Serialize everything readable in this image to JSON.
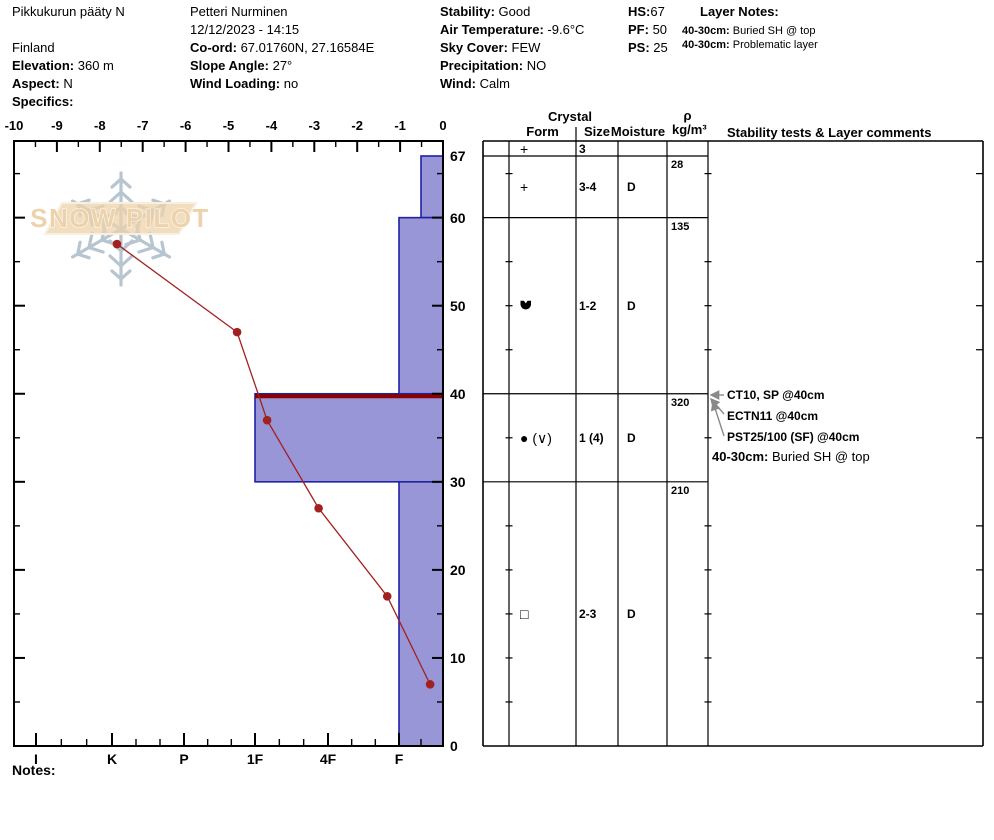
{
  "header": {
    "site": "Pikkukurun pääty N",
    "country": "Finland",
    "observer": "Petteri Nurminen",
    "datetime": "12/12/2023 - 14:15",
    "labels": {
      "elevation": "Elevation:",
      "aspect": "Aspect:",
      "specifics": "Specifics:",
      "coord": "Co-ord:",
      "slope": "Slope Angle:",
      "wind_loading": "Wind Loading:",
      "stability": "Stability:",
      "air_temp": "Air Temperature:",
      "sky": "Sky Cover:",
      "precip": "Precipitation:",
      "wind": "Wind:",
      "hs": "HS:",
      "pf": "PF:",
      "ps": "PS:",
      "layer_notes": "Layer Notes:"
    },
    "values": {
      "elevation": "360 m",
      "aspect": "N",
      "specifics": "",
      "coord": "67.01760N, 27.16584E",
      "slope": "27°",
      "wind_loading": "no",
      "stability": "Good",
      "air_temp": "-9.6°C",
      "sky": "FEW",
      "precip": "NO",
      "wind": "Calm",
      "hs": "67",
      "pf": "50",
      "ps": "25"
    },
    "layer_notes": [
      {
        "range": "40-30cm:",
        "text": "Buried SH @ top"
      },
      {
        "range": "40-30cm:",
        "text": "Problematic layer"
      }
    ]
  },
  "chart_data": {
    "type": "snow-profile",
    "snow_height_cm": 67,
    "temperature_axis": {
      "unit": "°C",
      "min": -10,
      "max": 0,
      "tick_labels": [
        "-10",
        "-9",
        "-8",
        "-7",
        "-6",
        "-5",
        "-4",
        "-3",
        "-2",
        "-1",
        "0"
      ]
    },
    "height_axis": {
      "unit": "cm",
      "min": 0,
      "top_cm": 68.7,
      "tick_labels": [
        67,
        60,
        50,
        40,
        30,
        20,
        10,
        0
      ]
    },
    "hardness_axis": {
      "labels": [
        "I",
        "K",
        "P",
        "1F",
        "4F",
        "F"
      ]
    },
    "temperature_profile": [
      {
        "height_cm": 57,
        "temp_c": -7.6
      },
      {
        "height_cm": 47,
        "temp_c": -4.8
      },
      {
        "height_cm": 37,
        "temp_c": -4.1
      },
      {
        "height_cm": 27,
        "temp_c": -2.9
      },
      {
        "height_cm": 17,
        "temp_c": -1.3
      },
      {
        "height_cm": 7,
        "temp_c": -0.3
      }
    ],
    "hardness_layers": [
      {
        "top_cm": 67,
        "bottom_cm": 60,
        "hardness": "F-",
        "flagged_top": false
      },
      {
        "top_cm": 60,
        "bottom_cm": 40,
        "hardness": "F",
        "flagged_top": false
      },
      {
        "top_cm": 40,
        "bottom_cm": 30,
        "hardness": "1F",
        "flagged_top": true
      },
      {
        "top_cm": 30,
        "bottom_cm": 0,
        "hardness": "F",
        "flagged_top": false
      }
    ]
  },
  "grain_table": {
    "headers": {
      "crystal": "Crystal",
      "form": "Form",
      "size": "Size",
      "moisture": "Moisture",
      "rho": "ρ",
      "rho_unit": "kg/m³",
      "stability": "Stability tests & Layer comments"
    },
    "rows": [
      {
        "top_cm": null,
        "bottom_cm": 67,
        "form": "+",
        "form_code": "PP",
        "size": "3",
        "moisture": "",
        "density": ""
      },
      {
        "top_cm": 67,
        "bottom_cm": 60,
        "form": "+",
        "form_code": "PP",
        "size": "3-4",
        "moisture": "D",
        "density": "28"
      },
      {
        "top_cm": 60,
        "bottom_cm": 40,
        "form": "DF",
        "form_code": "DF",
        "size": "1-2",
        "moisture": "D",
        "density": "135"
      },
      {
        "top_cm": 40,
        "bottom_cm": 30,
        "form": "● (∨)",
        "form_code": "RG(SH)",
        "size": "1 (4)",
        "moisture": "D",
        "density": "320"
      },
      {
        "top_cm": 30,
        "bottom_cm": 0,
        "form": "□",
        "form_code": "FC",
        "size": "2-3",
        "moisture": "D",
        "density": "210"
      }
    ]
  },
  "stability_tests": [
    "CT10, SP @40cm",
    "ECTN11 @40cm",
    "PST25/100 (SF) @40cm"
  ],
  "stability_comment": {
    "range": "40-30cm:",
    "text": "Buried SH @ top"
  },
  "notes_label": "Notes:",
  "logo_text": "SNOW PILOT",
  "colors": {
    "bar_fill": "#9896d7",
    "bar_border": "#2121a3",
    "flag_line": "#8b0000",
    "temp_line": "#a32020",
    "arrow": "#8a8a8a",
    "logo_flake": "#b7c5d1",
    "logo_banner": "#eed2aa",
    "logo_text_fill": "#ecd3ab"
  }
}
